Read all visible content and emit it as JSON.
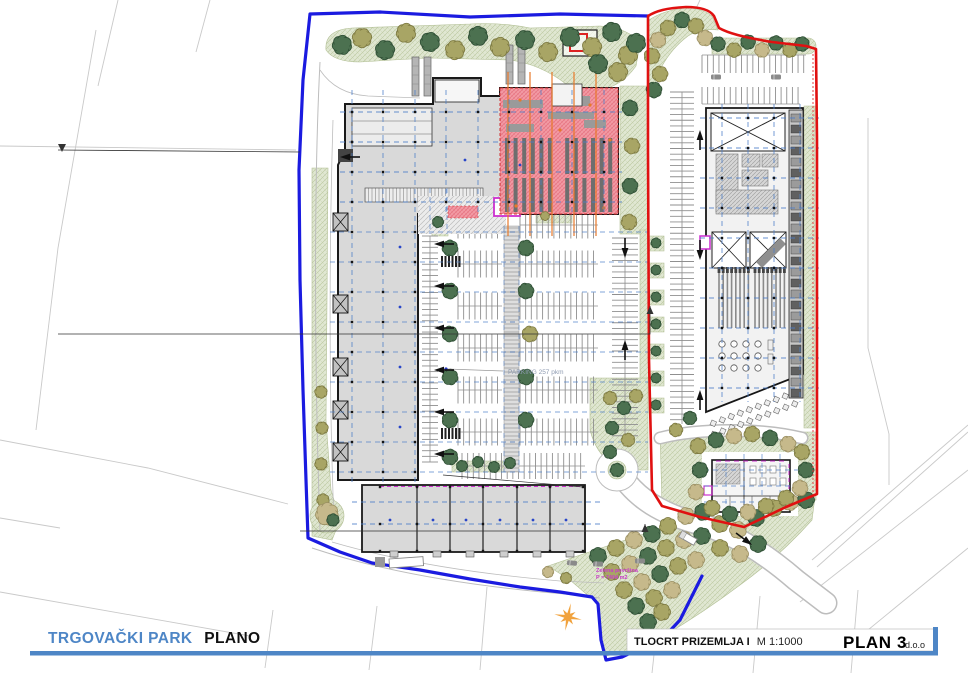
{
  "titlebar": {
    "project_blue": "TRGOVAČKI PARK",
    "project_black": "PLANO",
    "drawing_title": "TLOCRT PRIZEMLJA I",
    "scale": "M 1:1000",
    "company": "PLAN 3",
    "company_suffix": "d.o.o"
  },
  "plan": {
    "parking_label": "PARKING 257 pkm",
    "green_area_label": "Zelena površina",
    "green_area_value": "P = 7404 m2"
  },
  "colors": {
    "boundary_blue": "#1b1be0",
    "boundary_red": "#e01111",
    "building_fill": "#d9d9d9",
    "building_outline": "#1a1a1a",
    "retail_pink": "#f29aa4",
    "pink_outline": "#d03030",
    "grid_blue": "#4d7ec8",
    "axis_orange": "#e8792a",
    "green_fill": "#e0e7d2",
    "tree_dark": "#4c7150",
    "tree_dark_stroke": "#2f4f35",
    "tree_olive": "#a8a565",
    "tree_olive_stroke": "#7d7a42",
    "tree_tan": "#c6b98b",
    "tree_tan_stroke": "#9a8f62",
    "road_edge": "#bdbdbd",
    "stall_gray": "#8f8f8f",
    "magenta": "#cc2fcf",
    "sun_orange": "#f1a23c",
    "title_blue": "#4e86c6",
    "label_gray": "#8d9ab0",
    "cadastral_gray": "#c9c9c9"
  }
}
